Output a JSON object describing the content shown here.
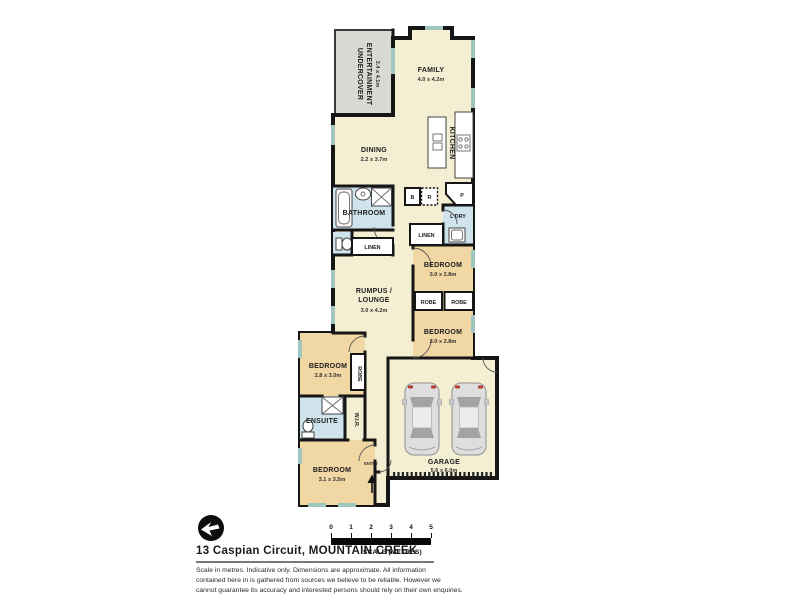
{
  "floorplan": {
    "colors": {
      "living": "#f4efd2",
      "bedroom": "#f0d7a3",
      "wet": "#cfe3ec",
      "outdoor": "#d9d8d3",
      "window": "#9fc7c0",
      "wall": "#161616"
    },
    "rooms": {
      "undercover": {
        "line1": "UNDERCOVER",
        "line2": "ENTERTAINMENT",
        "dims": "3.4 x 4.1m"
      },
      "family": {
        "label": "FAMILY",
        "dims": "4.0 x 4.2m"
      },
      "dining": {
        "label": "DINING",
        "dims": "2.2 x 3.7m"
      },
      "kitchen": {
        "label": "KITCHEN"
      },
      "bathroom": {
        "label": "BATHROOM"
      },
      "laundry": {
        "label": "L'DRY"
      },
      "linen_right": {
        "label": "LINEN"
      },
      "linen_left": {
        "label": "LINEN"
      },
      "rumpus": {
        "line1": "RUMPUS /",
        "line2": "LOUNGE",
        "dims": "3.0 x 4.2m"
      },
      "bedroom_ne": {
        "label": "BEDROOM",
        "dims": "3.0 x 2.8m"
      },
      "bedroom_se": {
        "label": "BEDROOM",
        "dims": "3.0 x 2.8m"
      },
      "robe_ne": {
        "label": "ROBE"
      },
      "robe_se": {
        "label": "ROBE"
      },
      "bedroom_w": {
        "label": "BEDROOM",
        "dims": "2.8 x 3.0m"
      },
      "robe_w": {
        "label": "ROBE"
      },
      "ensuite": {
        "label": "ENSUITE"
      },
      "wir": {
        "label": "W.I.R."
      },
      "bedroom_sw": {
        "label": "BEDROOM",
        "dims": "3.1 x 3.5m"
      },
      "entry": {
        "label": "ENTRY"
      },
      "garage": {
        "label": "GARAGE",
        "dims": "5.6 x 6.0m"
      },
      "appliance_b": {
        "label": "B"
      },
      "appliance_r": {
        "label": "R"
      },
      "pantry": {
        "label": "P"
      }
    }
  },
  "footer": {
    "address": "13 Caspian Circuit, MOUNTAIN CREEK",
    "scale_caption": "SCALE (METRES)",
    "scale_ticks": [
      "0",
      "1",
      "2",
      "3",
      "4",
      "5"
    ],
    "disclaimer_lines": [
      "Scale in metres. Indicative only. Dimensions are approximate. All information",
      "contained here in is gathered from sources we believe to be reliable. However we",
      "cannot guarantee its accuracy and interested persons should rely on their own enquiries."
    ]
  }
}
